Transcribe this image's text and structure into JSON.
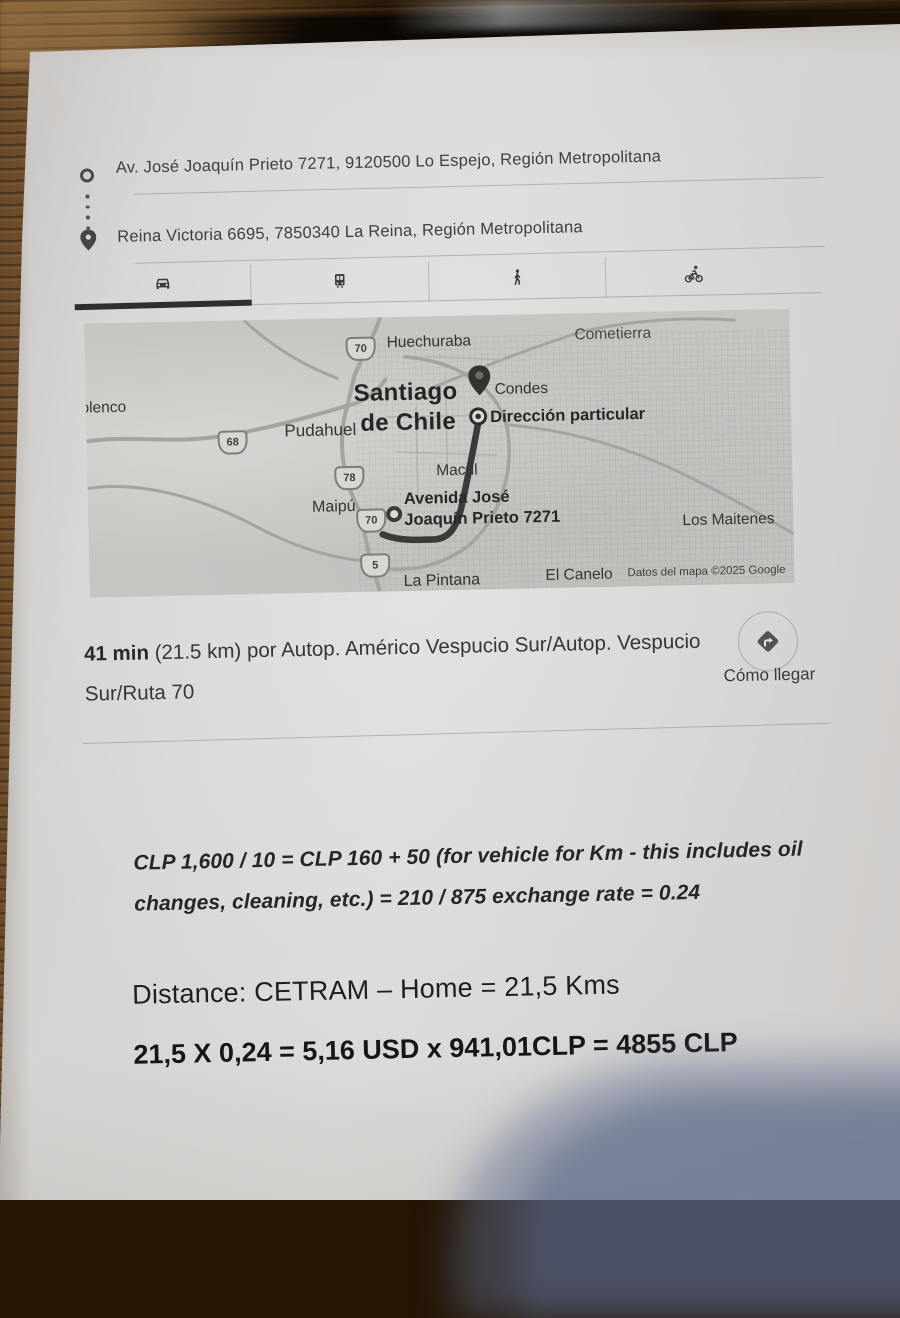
{
  "addresses": {
    "origin": "Av. José Joaquín Prieto 7271, 9120500 Lo Espejo, Región Metropolitana",
    "destination": "Reina Victoria 6695, 7850340 La Reina, Región Metropolitana"
  },
  "transport_tabs": {
    "modes": [
      "car",
      "transit",
      "walking",
      "cycling"
    ],
    "selected": "car"
  },
  "map": {
    "labels": [
      {
        "text": "Huechuraba"
      },
      {
        "text": "Cometierra"
      },
      {
        "text": "Lolenco"
      },
      {
        "text": "Santiago"
      },
      {
        "text": "de Chile"
      },
      {
        "text": "Pudahuel"
      },
      {
        "text": "Condes"
      },
      {
        "text": "Dirección particular"
      },
      {
        "text": "Maipú"
      },
      {
        "text": "Macul"
      },
      {
        "text": "Avenida José"
      },
      {
        "text": "Joaquín Prieto 7271"
      },
      {
        "text": "Los Maitenes"
      },
      {
        "text": "La Pintana"
      },
      {
        "text": "El Canelo"
      }
    ],
    "shields": [
      "70",
      "68",
      "78",
      "70",
      "5"
    ],
    "copyright": "Datos del mapa ©2025 Google"
  },
  "summary": {
    "duration": "41 min",
    "line1_rest": " (21.5 km) por Autop. Américo Vespucio Sur/Autop. Vespucio",
    "line2": "Sur/Ruta 70",
    "directions_label": "Cómo llegar"
  },
  "notes": {
    "formula_line1": "CLP 1,600 / 10 = CLP 160 + 50 (for vehicle for Km - this includes oil",
    "formula_line2": "changes, cleaning, etc.) = 210 / 875 exchange rate = 0.24",
    "distance_line": "Distance: CETRAM – Home = 21,5 Kms",
    "calc_line": "21,5 X 0,24 = 5,16 USD x 941,01CLP = 4855 CLP"
  },
  "colors": {
    "paper": "#d8d6d4",
    "map_background": "#c7c5c2",
    "route": "#3b3a38",
    "tab_active_underline": "#2f2e2c",
    "phone_shadow": "#6e80a4",
    "wood": "#3a2512"
  }
}
